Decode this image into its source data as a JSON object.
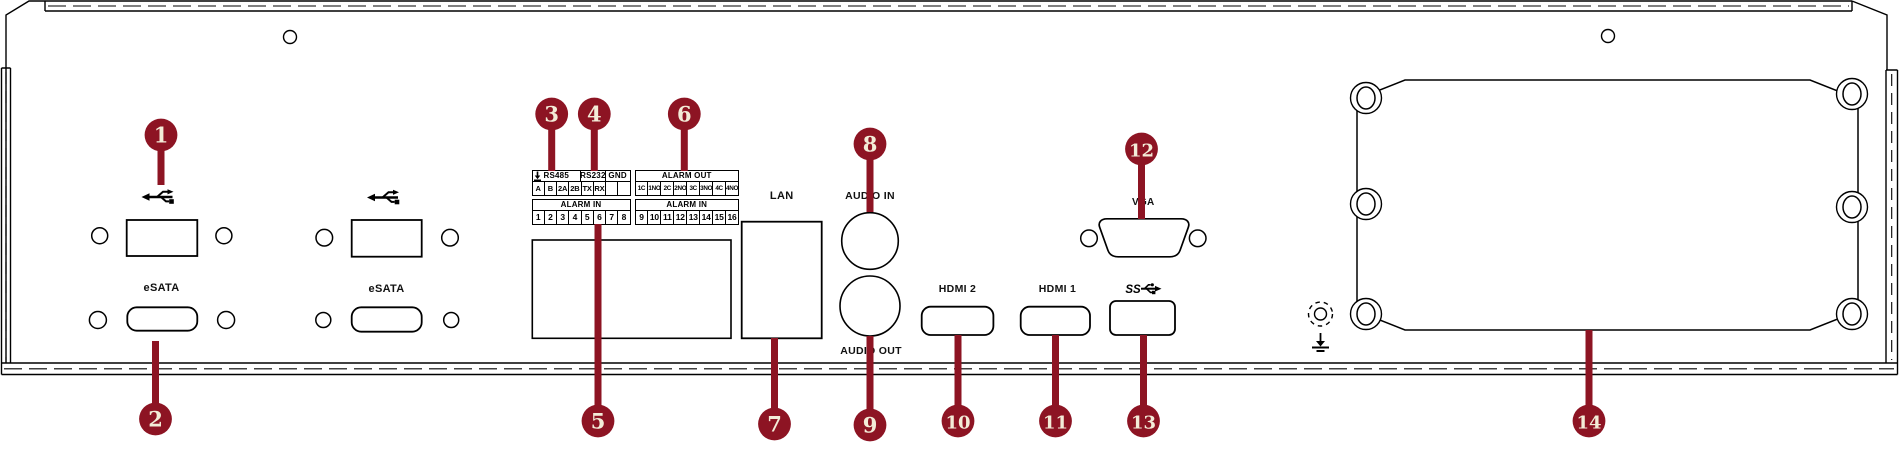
{
  "figure": "rear-panel-connector-diagram",
  "colors": {
    "callout_badge": "#8D1423",
    "line": "#000000",
    "background": "#ffffff",
    "callout_number_text": "#F3ECD8"
  },
  "callouts": [
    {
      "number": "1"
    },
    {
      "number": "2"
    },
    {
      "number": "3"
    },
    {
      "number": "4"
    },
    {
      "number": "5"
    },
    {
      "number": "6"
    },
    {
      "number": "7"
    },
    {
      "number": "8"
    },
    {
      "number": "9"
    },
    {
      "number": "10"
    },
    {
      "number": "11"
    },
    {
      "number": "12"
    },
    {
      "number": "13"
    },
    {
      "number": "14"
    }
  ],
  "labels": {
    "esata_1": "eSATA",
    "esata_2": "eSATA",
    "lan": "LAN",
    "audio_in": "AUDIO IN",
    "audio_out": "AUDIO OUT",
    "hdmi_2": "HDMI 2",
    "hdmi_1": "HDMI 1",
    "usb_ss": "SS",
    "vga": "VGA"
  },
  "icons": {
    "usb_ports": [
      "usb-icon",
      "usb-icon"
    ],
    "usb30_logo": "usb-ss-icon",
    "serial_ground_cells": [
      "earth-ground-icon",
      "earth-ground-icon"
    ],
    "chassis_ground": [
      "grounding-screw-icon",
      "earth-ground-icon"
    ]
  },
  "terminal_blocks": {
    "serial": {
      "headers": [
        "RS485",
        "RS232",
        "GND"
      ],
      "pins": [
        "A",
        "B",
        "2A",
        "2B",
        "TX",
        "RX"
      ]
    },
    "alarm_out": {
      "header": "ALARM OUT",
      "pins": [
        "1C",
        "1NO",
        "2C",
        "2NO",
        "3C",
        "3NO",
        "4C",
        "4NO"
      ]
    },
    "alarm_in_left": {
      "header": "ALARM IN",
      "pins": [
        "1",
        "2",
        "3",
        "4",
        "5",
        "6",
        "7",
        "8"
      ]
    },
    "alarm_in_right": {
      "header": "ALARM IN",
      "pins": [
        "9",
        "10",
        "11",
        "12",
        "13",
        "14",
        "15",
        "16"
      ]
    }
  }
}
